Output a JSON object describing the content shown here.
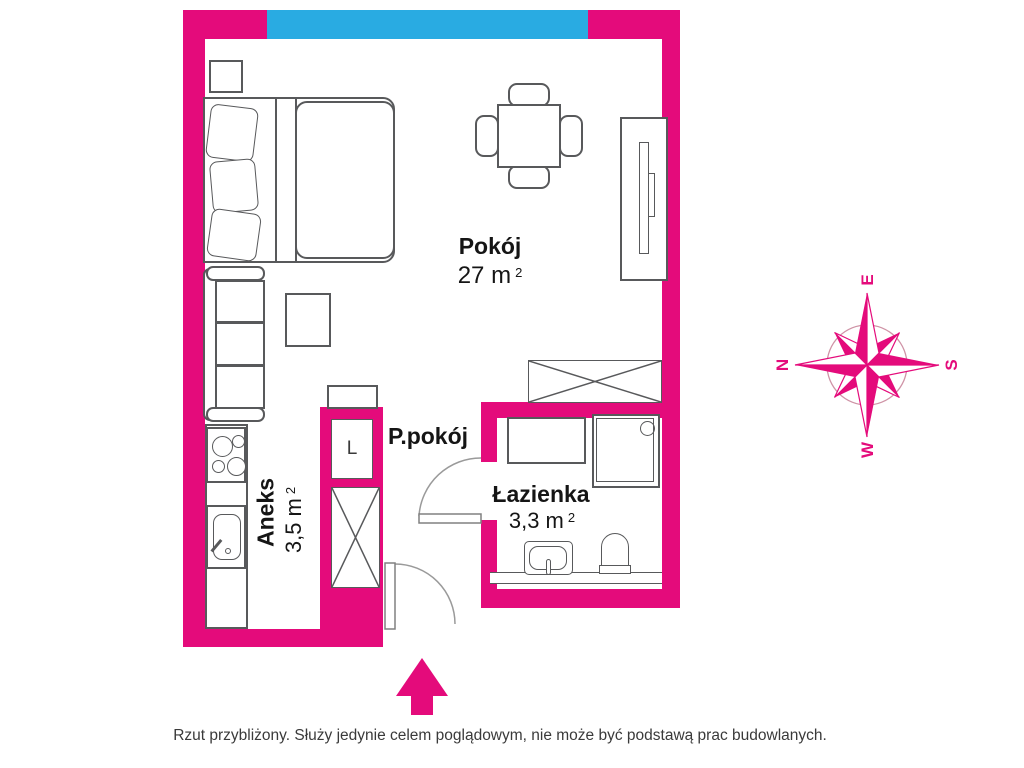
{
  "plan": {
    "rooms": {
      "pokoj": {
        "name": "Pokój",
        "area": "27 m",
        "sup": "2"
      },
      "ppokoj": {
        "name": "P.pokój"
      },
      "aneks": {
        "name": "Aneks",
        "area": "3,5 m",
        "sup": "2"
      },
      "lazienka": {
        "name": "Łazienka",
        "area": "3,3 m",
        "sup": "2"
      }
    },
    "markers": {
      "fridge_label": "L"
    },
    "colors": {
      "wall_pink": "#E40B7B",
      "window_blue": "#29ABE2",
      "furniture_outline": "#58595B"
    }
  },
  "compass": {
    "n": "N",
    "e": "E",
    "s": "S",
    "w": "W"
  },
  "footer": {
    "disclaimer": "Rzut przybliżony. Służy jedynie celem poglądowym, nie może być podstawą prac budowlanych."
  }
}
